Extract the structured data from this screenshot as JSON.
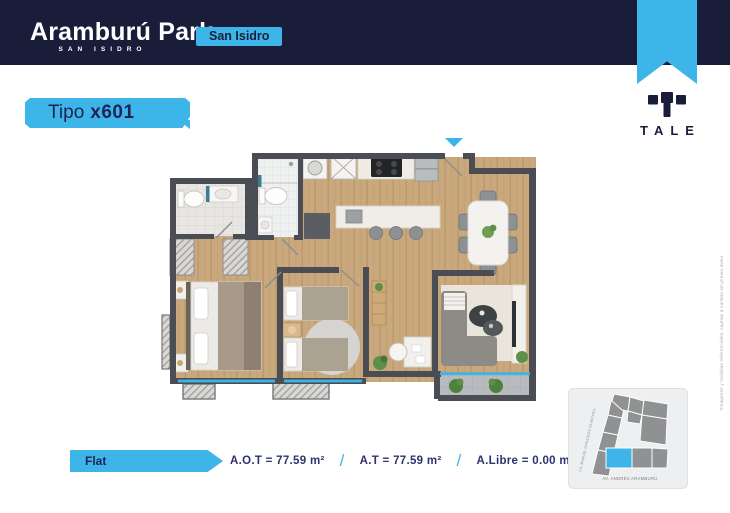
{
  "colors": {
    "navy": "#1a1d3a",
    "cyan": "#3db5e8"
  },
  "header": {
    "title": "Aramburú Park",
    "subtitle": "SAN ISIDRO",
    "badge": "San Isidro"
  },
  "brand": {
    "logo": "TALE"
  },
  "unit": {
    "type_label": "Tipo",
    "type_code": "x601",
    "category": "Flat"
  },
  "specs": {
    "items": [
      {
        "text": "A.O.T = 77.59 m²"
      },
      {
        "text": "A.T = 77.59 m²"
      },
      {
        "text": "A.Libre = 0.00 m²"
      }
    ],
    "separator": "/"
  },
  "map": {
    "street_left": "CA. MANUEL GONZÁLES OLAECHEA",
    "street_bottom": "AV. ANDRÉS ARAMBURÚ"
  },
  "disclaimer": "*Imágenes y medidas referenciales, sujetas a cambio sin previo aviso"
}
